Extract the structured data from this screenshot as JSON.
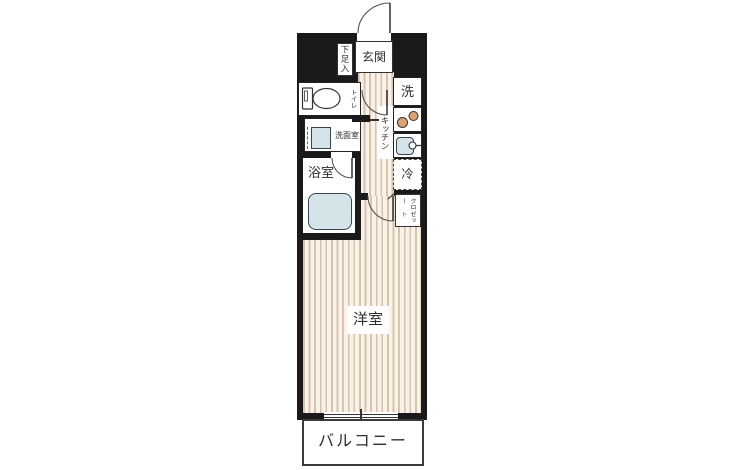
{
  "plan": {
    "type": "japanese-apartment-floor-plan",
    "labels": {
      "genkan": "玄関",
      "shoe_cabinet": "下足入",
      "toilet": "トイレ",
      "washroom": "洗面室",
      "bathroom": "浴室",
      "kitchen": "キッチン",
      "washer": "洗",
      "fridge": "冷",
      "closet_col1": "クロー",
      "closet_col2": "ゼット",
      "main_room": "洋室",
      "balcony": "バルコニー"
    },
    "colors": {
      "wall": "#1a1a1a",
      "floor_stripe": "#d9c3ab",
      "floor_bg": "#f8f2e9",
      "water_fixture_blue": "#d4e4e8",
      "burner_orange": "#dfa26b",
      "outline": "#333333",
      "text": "#2e2e2e"
    }
  }
}
